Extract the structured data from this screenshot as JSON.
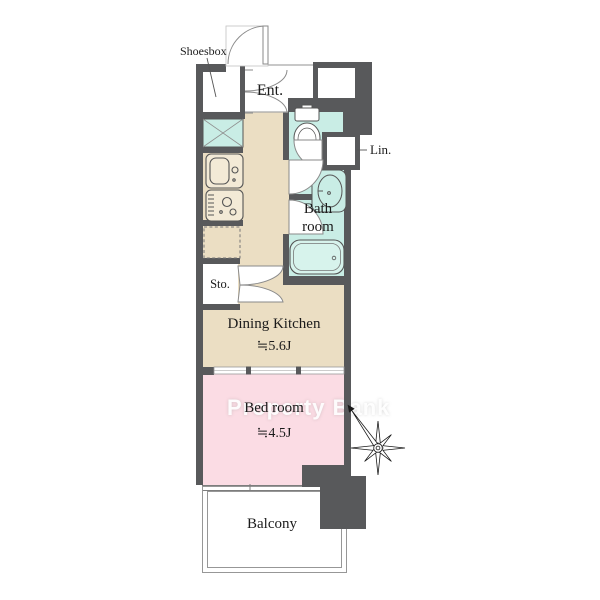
{
  "floor_plan": {
    "watermark": "Property Bank",
    "labels": {
      "shoesbox": "Shoesbox",
      "entrance": "Ent.",
      "linen": "Lin.",
      "bathroom": "Bath room",
      "bathroom_lines": [
        "Bath",
        "room"
      ],
      "storage": "Sto.",
      "dining_kitchen_name": "Dining Kitchen",
      "dining_kitchen_size": "≒5.6J",
      "bedroom_name": "Bed room",
      "bedroom_size": "≒4.5J",
      "balcony": "Balcony"
    },
    "colors": {
      "wall": "#58595b",
      "dining_kitchen_floor": "#ebdec3",
      "wet_area_floor": "#c9ede5",
      "bedroom_floor": "#fbdce4",
      "fixture_outline": "#555555",
      "thin_line": "#979797",
      "watermark_text": "#ffffff"
    },
    "icons": [
      "toilet-icon",
      "washbasin-icon",
      "bathtub-icon",
      "kitchen-sink-icon",
      "stove-icon",
      "washing-machine-pan-icon",
      "refrigerator-space-icon",
      "door-swing-arc",
      "double-door-arc",
      "sliding-door",
      "compass-star-icon",
      "north-arrow-icon"
    ]
  }
}
